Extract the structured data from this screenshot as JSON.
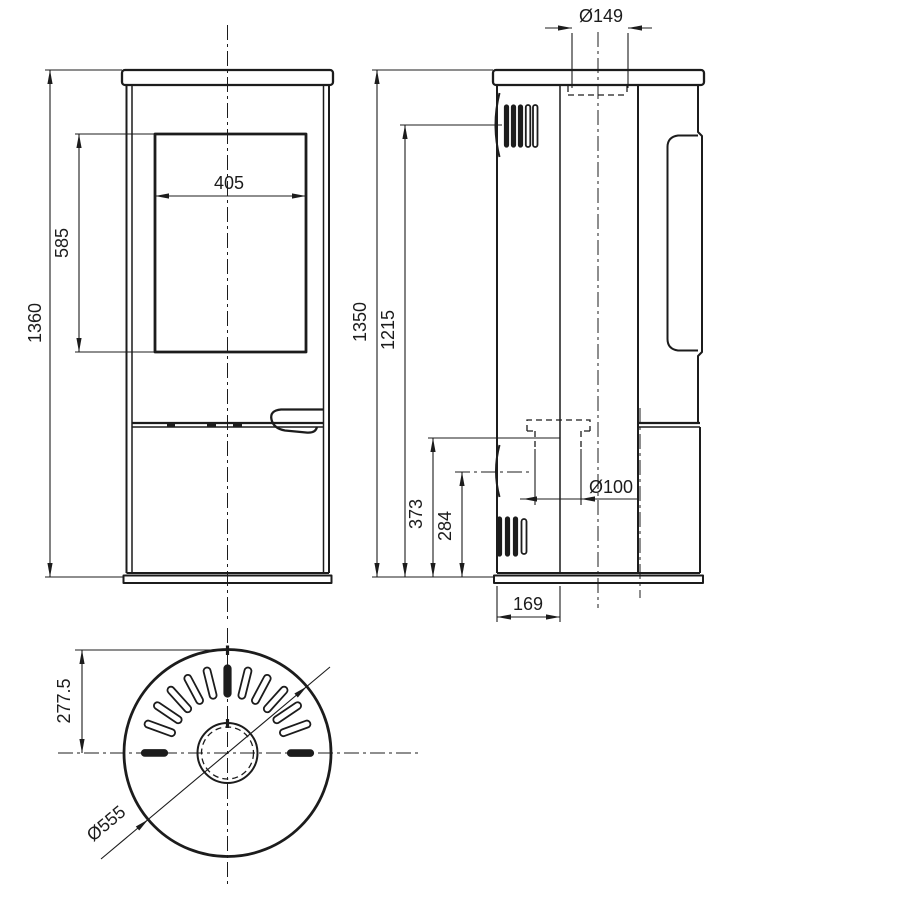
{
  "drawing": {
    "background": "#ffffff",
    "line_color": "#1c1c1c",
    "views": {
      "front": "front-view",
      "side": "side-view",
      "top": "top-view"
    },
    "dimensions": {
      "window_width": "405",
      "window_height": "585",
      "front_total_height": "1360",
      "side_total_height": "1350",
      "upper_vent_height": "1215",
      "rear_connection_height": "373",
      "lower_vent_height": "284",
      "air_inlet_offset": "169",
      "flue_diameter": "Ø149",
      "rear_connection_diameter": "Ø100",
      "top_view_radius": "277.5",
      "body_diameter": "Ø555"
    }
  }
}
